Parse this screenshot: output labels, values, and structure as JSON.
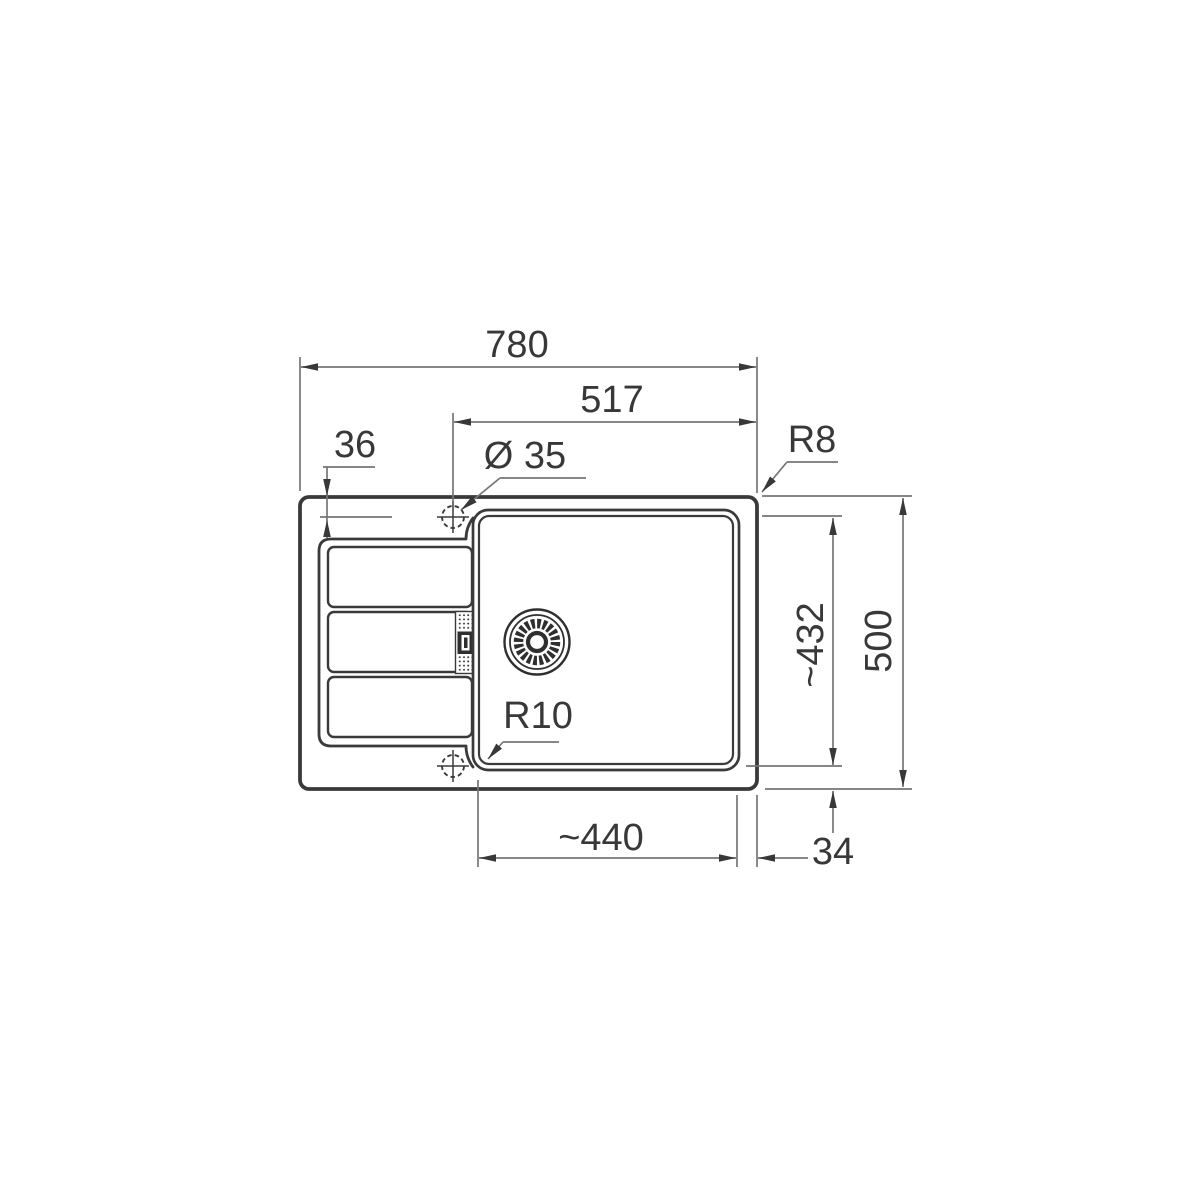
{
  "drawing": {
    "background_color": "#ffffff",
    "outline_color": "#3a3a3a",
    "dimension_line_color": "#757575",
    "text_color": "#383838",
    "dims": {
      "overall_width": "780",
      "tap_center_to_right_edge": "517",
      "top_edge_to_tap_center": "36",
      "tap_hole_diameter": "Ø 35",
      "outer_corner_radius": "R8",
      "bowl_depth_front_back": "~432",
      "overall_depth": "500",
      "bowl_inner_corner_radius": "R10",
      "bowl_width": "~440",
      "bowl_to_edge_gap": "34"
    }
  }
}
